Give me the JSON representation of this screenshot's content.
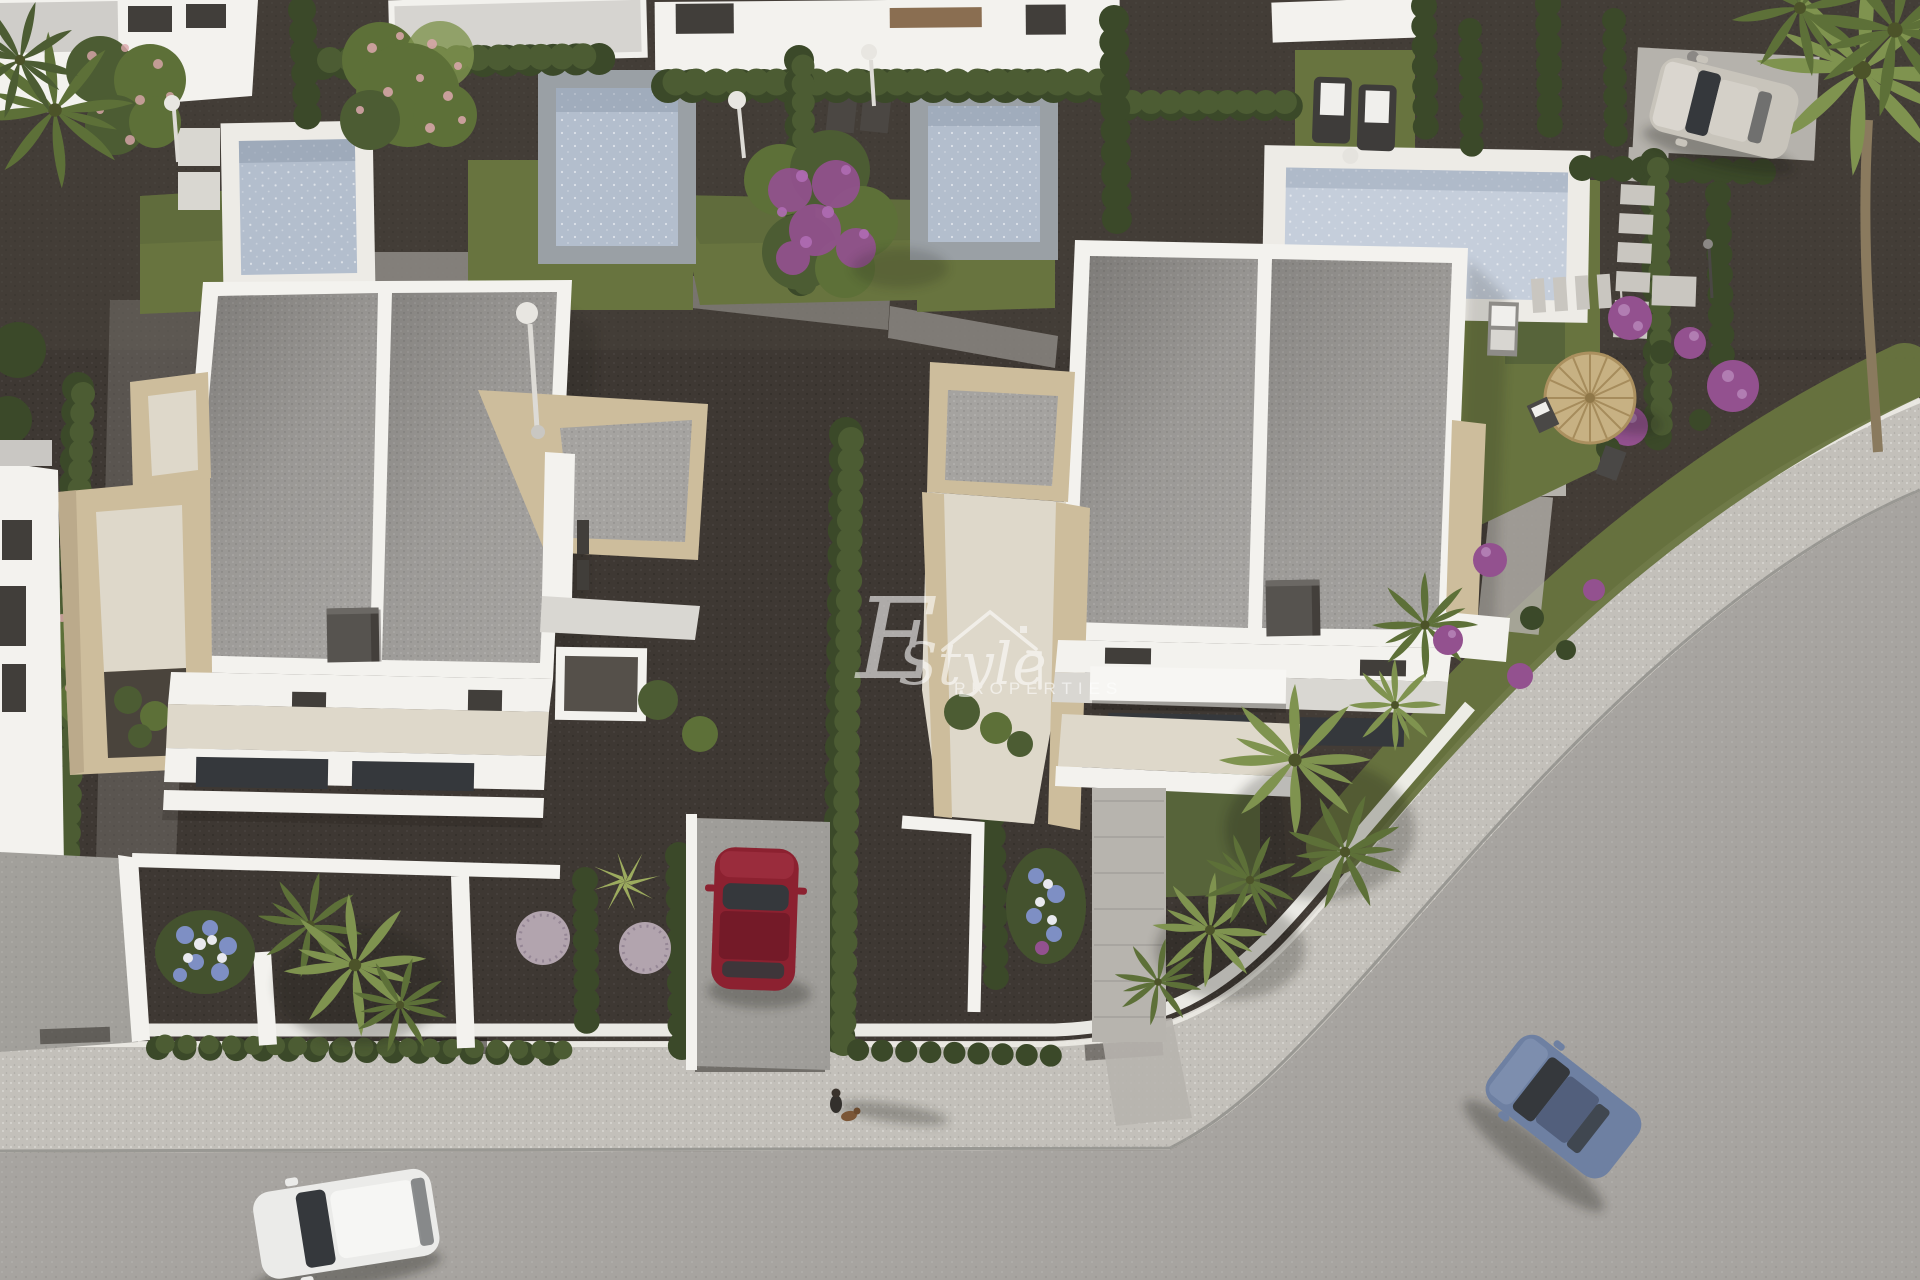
{
  "scene": {
    "type": "aerial-3d-architectural-render",
    "description": "Bird's-eye render of a new-build residential development: two modern white flat-roof villas with beige stone stair towers, private pools with hedges and gardens in the upper plots, a red car on a driveway, a white car and a blue car on the curving street, a silver car parked top-right, palms, purple flowering shrubs, a round straw parasol with chairs, sun loungers, stepping-stone paths and a person walking a dog on the sidewalk."
  },
  "watermark": {
    "initial": "E",
    "name": "Style",
    "subtitle": "PROPERTIES",
    "icon": "house-outline"
  },
  "inventory": {
    "villas": 2,
    "pools": 4,
    "vehicles": [
      {
        "type": "hatchback",
        "color": "white",
        "location": "bottom street"
      },
      {
        "type": "sedan",
        "color": "dark red",
        "location": "driveway between villas"
      },
      {
        "type": "sedan",
        "color": "blue grey",
        "location": "curving street bottom right"
      },
      {
        "type": "hatchback",
        "color": "silver beige",
        "location": "parking pad top right"
      }
    ],
    "people": [
      {
        "type": "pedestrian-with-dog",
        "location": "sidewalk bottom center"
      }
    ],
    "garden_features": [
      "cypress hedges",
      "palm trees",
      "purple flowering shrubs",
      "blue-white flower beds",
      "round straw parasol",
      "two sun loungers with towels",
      "outdoor sofa",
      "stepping stones",
      "outdoor shower poles",
      "spherical ornamental bushes"
    ]
  },
  "palette": {
    "gravel": "#3e3833",
    "gravelwarm": "#4a443c",
    "pathgrey": "#8e8b86",
    "road": "#a7a4a0",
    "sidewalk": "#c3c0ba",
    "curb": "#edebe6",
    "lawn": "#68743f",
    "lawnshade": "#57643a",
    "hedge": "#4c5c33",
    "hedgedark": "#3b4929",
    "roofgravel": "#a5a3a0",
    "wallwhite": "#f3f2ee",
    "wallshade": "#d9d7d2",
    "stone": "#cdbd9c",
    "stoneshade": "#b3a384",
    "terrace": "#ded8ca",
    "poolwater": "#b3becd",
    "poolwaterlight": "#c5cedb",
    "poolcoping": "#9aa0a5",
    "windowdark": "#413e3a",
    "chimney": "#56534f",
    "glassdark": "#35383c",
    "carred": "#8c2130",
    "carredroof": "#741a28",
    "carblue": "#6e80a2",
    "carbluedark": "#525f7c",
    "carwhite": "#ebebe9",
    "carsilver": "#c8c4bb",
    "flowerpurple": "#93518f",
    "flowermagenta": "#7c3f88",
    "flowerblue": "#7e8fc4",
    "flowerpink": "#dca8ad",
    "ballbush": "#b2a4ae",
    "palm": "#7f934f",
    "palmdark": "#5d7038",
    "parasol": "#c7b183",
    "trunk": "#8a7a5e",
    "towel": "#f0efec",
    "slab": "#c9c6c0",
    "shadow": "#1f1b17"
  }
}
